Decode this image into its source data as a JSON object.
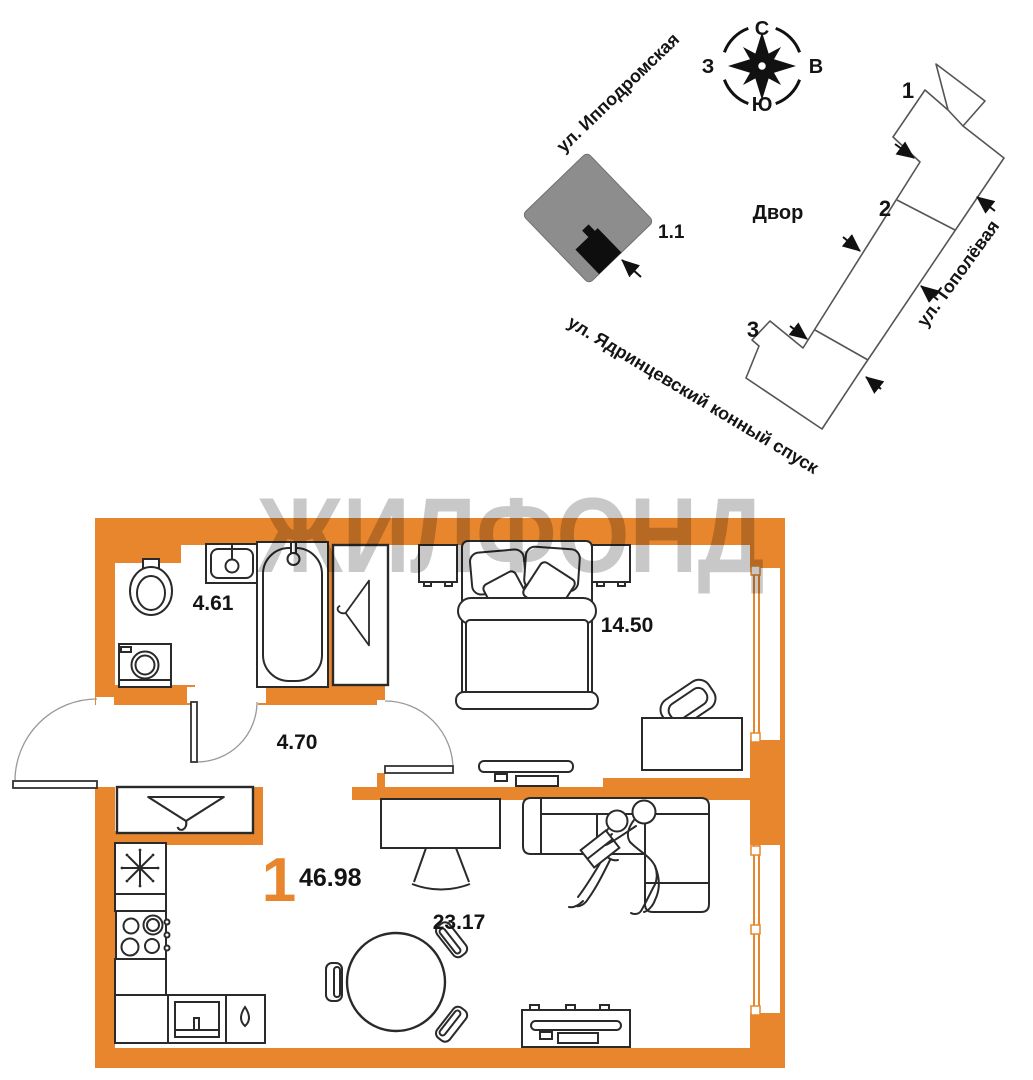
{
  "site_plan": {
    "compass": {
      "north": "С",
      "south": "Ю",
      "west": "З",
      "east": "В"
    },
    "streets": {
      "ippodromskaya": "ул. Ипподромская",
      "topolyovaya": "ул. Тополёвая",
      "yadrintsevsky": "ул. Ядринцевский конный спуск"
    },
    "courtyard_label": "Двор",
    "highlighted_unit_label": "1.1",
    "building_sections": [
      "1",
      "2",
      "3"
    ]
  },
  "floor_plan": {
    "watermark": "ЖИЛФОНД",
    "rooms_count": "1",
    "total_area": "46.98",
    "areas": {
      "bathroom": "4.61",
      "hallway": "4.70",
      "bedroom": "14.50",
      "kitchen_living": "23.17"
    }
  },
  "colors": {
    "wall_orange": "#E8862D",
    "building_gray": "#8D8D8D",
    "watermark_gray": "#C8C8C8"
  }
}
